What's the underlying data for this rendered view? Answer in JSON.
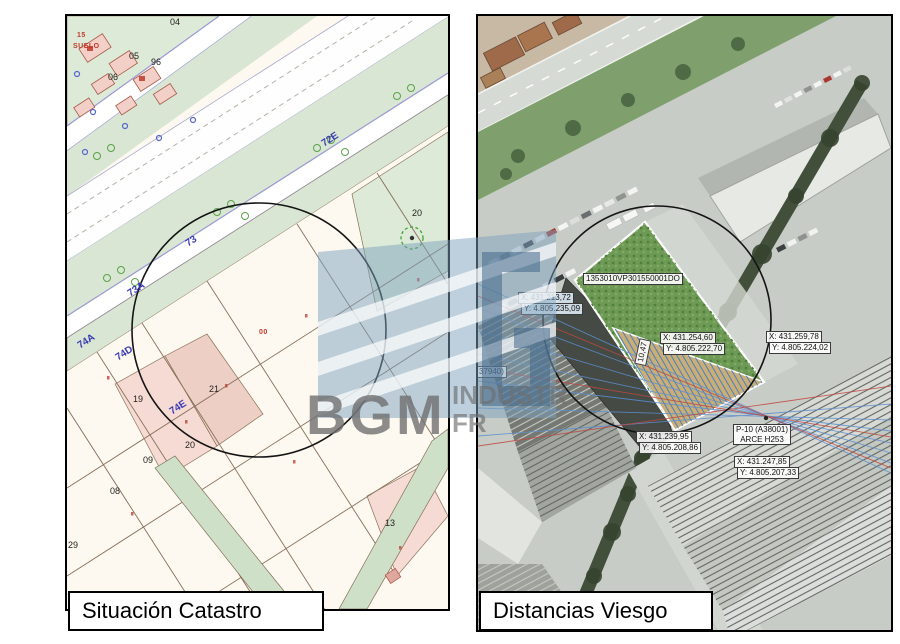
{
  "watermark": {
    "brand": "BGM",
    "line1": "INDUSTR",
    "line2": "FR"
  },
  "panels": {
    "left": {
      "caption": "Situación Catastro",
      "street_labels": [
        {
          "t": "72E",
          "x": 256,
          "y": 124,
          "r": -33
        },
        {
          "t": "73",
          "x": 120,
          "y": 224,
          "r": -33
        },
        {
          "t": "73A",
          "x": 62,
          "y": 274,
          "r": -33
        },
        {
          "t": "74A",
          "x": 12,
          "y": 326,
          "r": -33
        },
        {
          "t": "74D",
          "x": 50,
          "y": 338,
          "r": -33
        },
        {
          "t": "74E",
          "x": 104,
          "y": 392,
          "r": -33
        }
      ],
      "parcel_labels": [
        {
          "t": "04",
          "x": 103,
          "y": 2
        },
        {
          "t": "05",
          "x": 62,
          "y": 36
        },
        {
          "t": "96",
          "x": 84,
          "y": 42
        },
        {
          "t": "06",
          "x": 41,
          "y": 57
        },
        {
          "t": "20",
          "x": 345,
          "y": 193
        },
        {
          "t": "21",
          "x": 142,
          "y": 369
        },
        {
          "t": "19",
          "x": 66,
          "y": 379
        },
        {
          "t": "20",
          "x": 118,
          "y": 425
        },
        {
          "t": "09",
          "x": 76,
          "y": 440
        },
        {
          "t": "08",
          "x": 43,
          "y": 471
        },
        {
          "t": "29",
          "x": 1,
          "y": 525
        },
        {
          "t": "13",
          "x": 318,
          "y": 503
        }
      ],
      "red_labels": [
        {
          "t": "15",
          "x": 10,
          "y": 16
        },
        {
          "t": "SUELO",
          "x": 6,
          "y": 27
        },
        {
          "t": "00",
          "x": 192,
          "y": 313
        }
      ]
    },
    "right": {
      "caption": "Distancias Viesgo",
      "ref_label": {
        "t": "1353010VP301550001DO",
        "x": 105,
        "y": 257
      },
      "measure_label": {
        "t": "10,47",
        "x": 152,
        "y": 330
      },
      "partial_label": {
        "t": "37940)",
        "x": -2,
        "y": 350
      },
      "pole_label": {
        "l1": "P-10 (A38001)",
        "l2": "ARCE H253",
        "x": 255,
        "y": 408
      },
      "coord_boxes": [
        {
          "l1": "X: 431.213,72",
          "l2": "Y: 4.805.235,09",
          "x": 40,
          "y": 276,
          "tint": true
        },
        {
          "l1": "X: 431.254,60",
          "l2": "Y: 4.805.222,70",
          "x": 182,
          "y": 316
        },
        {
          "l1": "X: 431.259,78",
          "l2": "Y: 4.805.224,02",
          "x": 288,
          "y": 315
        },
        {
          "l1": "X: 431.239,95",
          "l2": "Y: 4.805.208,86",
          "x": 158,
          "y": 415
        },
        {
          "l1": "X: 431.247,85",
          "l2": "Y: 4.805.207,33",
          "x": 256,
          "y": 440
        }
      ]
    }
  }
}
